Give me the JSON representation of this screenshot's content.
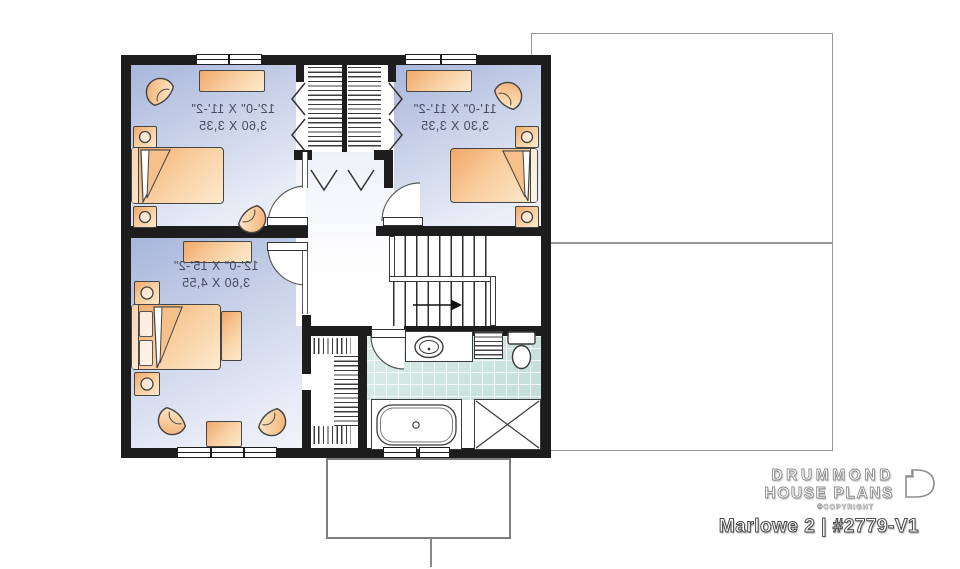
{
  "plan": {
    "rooms": [
      {
        "id": "bedroom-top-left",
        "imperial": "12'-0\" X 11'-2\"",
        "metric": "3,60 X 3,35"
      },
      {
        "id": "bedroom-top-right",
        "imperial": "11'-0\" X 11'-2\"",
        "metric": "3,30 X 3,35"
      },
      {
        "id": "bedroom-bottom-left",
        "imperial": "12'-0\" X 15'-2\"",
        "metric": "3,60 X 4,55"
      }
    ],
    "label_style": "mirrored"
  },
  "brand": {
    "name_line1": "DRUMMOND",
    "name_line2": "HOUSE PLANS",
    "copyright": "©COPYRIGHT",
    "plan_title": "Marlowe 2 | #2779-V1"
  },
  "colors": {
    "wall": "#1d1d1d",
    "bedroom_floor_dark": "#a7b6db",
    "bedroom_floor_light": "#f1f3fa",
    "furniture_dark": "#f1a768",
    "furniture_light": "#fdeacd",
    "bathroom_tile": "#c2ded8",
    "outline_gray": "#979797",
    "label_text": "#474b5e"
  }
}
